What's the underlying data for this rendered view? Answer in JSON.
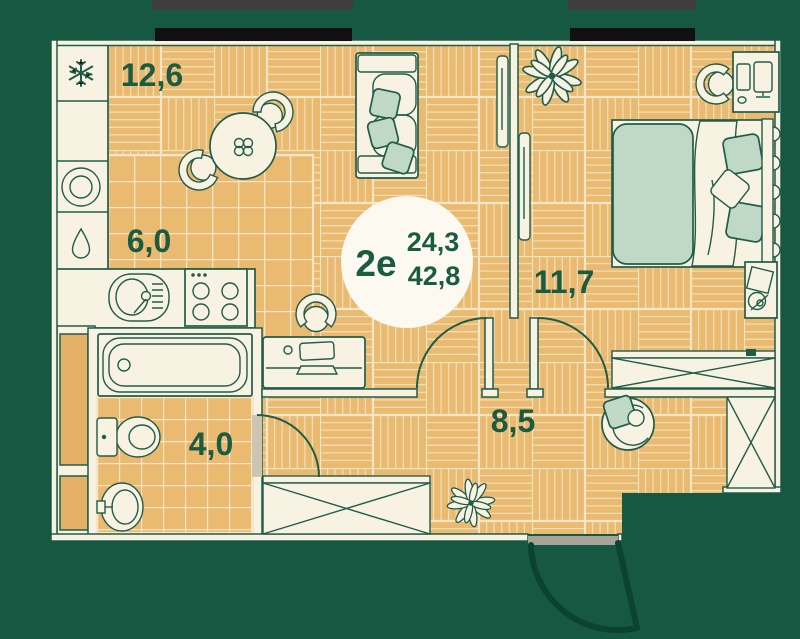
{
  "badge": {
    "type_label": "2е",
    "living_area": "24,3",
    "total_area": "42,8"
  },
  "rooms": {
    "living": {
      "name": "living-room",
      "area": "12,6"
    },
    "kitchen": {
      "name": "kitchen",
      "area": "6,0"
    },
    "bathroom": {
      "name": "bathroom",
      "area": "4,0"
    },
    "bedroom": {
      "name": "bedroom",
      "area": "11,7"
    },
    "hallway": {
      "name": "hallway",
      "area": "8,5"
    }
  },
  "icons": {
    "fridge": "snowflake-icon",
    "washer": "washing-machine-icon",
    "water": "droplet-icon"
  },
  "colors": {
    "background": "#175843",
    "outline": "#215c49",
    "walls": "#f8f2e3",
    "floor": "#eaba70",
    "floor_grout": "#f4e6c6",
    "textile_green": "#c0d8c6",
    "label_text": "#1a5b42",
    "window_glass": "#111111",
    "window_frame": "#3e3e3e",
    "entry_arc": "#0b4231"
  }
}
